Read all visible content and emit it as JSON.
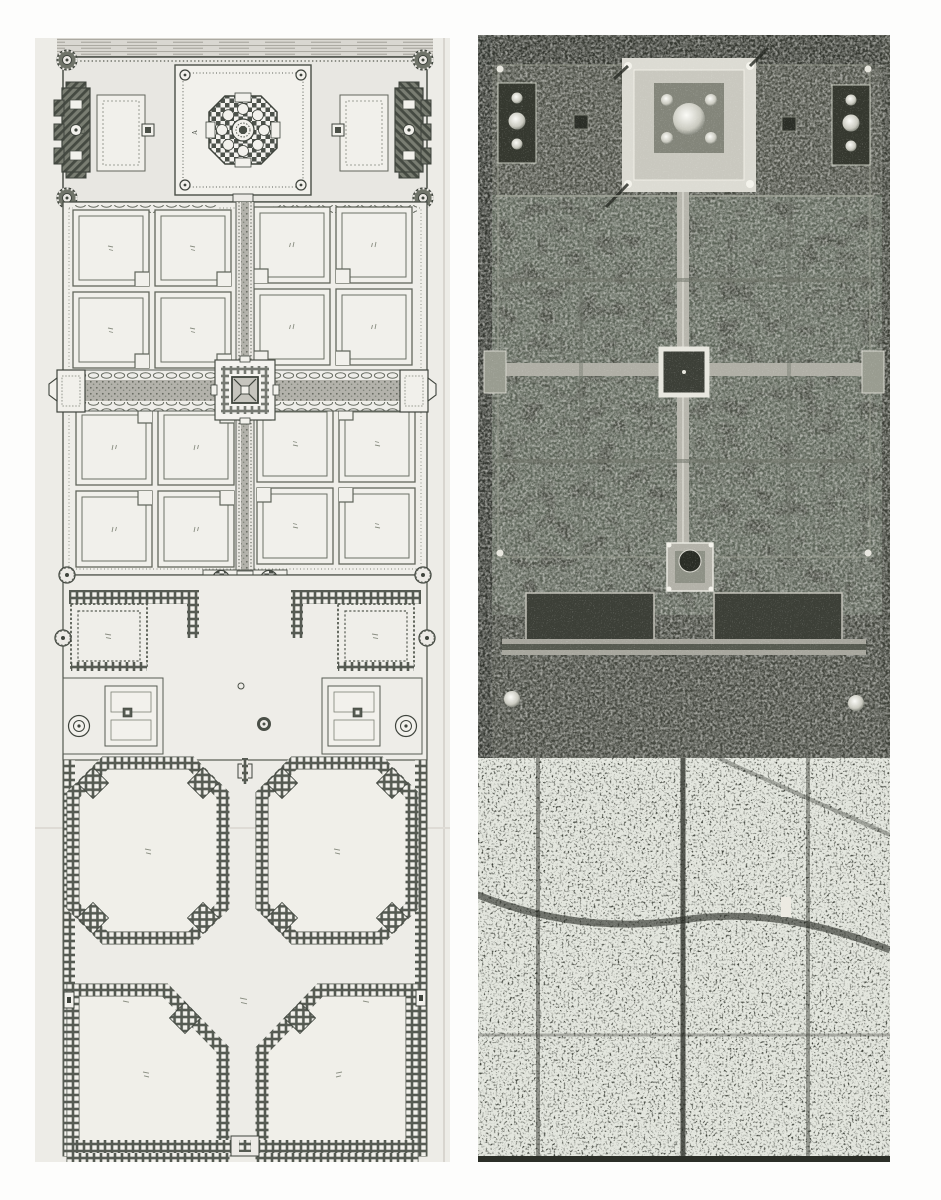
{
  "page": {
    "background": "#fdfdfc"
  },
  "colors": {
    "plan_paper": "#edece7",
    "plan_ink": "#4a4f47",
    "plan_white": "#f1f0eb",
    "photo_base": "#494c43",
    "photo_city": "#383c34",
    "photo_dark": "#2c2f28",
    "photo_light": "#dcdbd3"
  },
  "plan": {
    "annotations": {
      "mausoleum": "A",
      "mosque": "C",
      "jawab": "D"
    }
  }
}
